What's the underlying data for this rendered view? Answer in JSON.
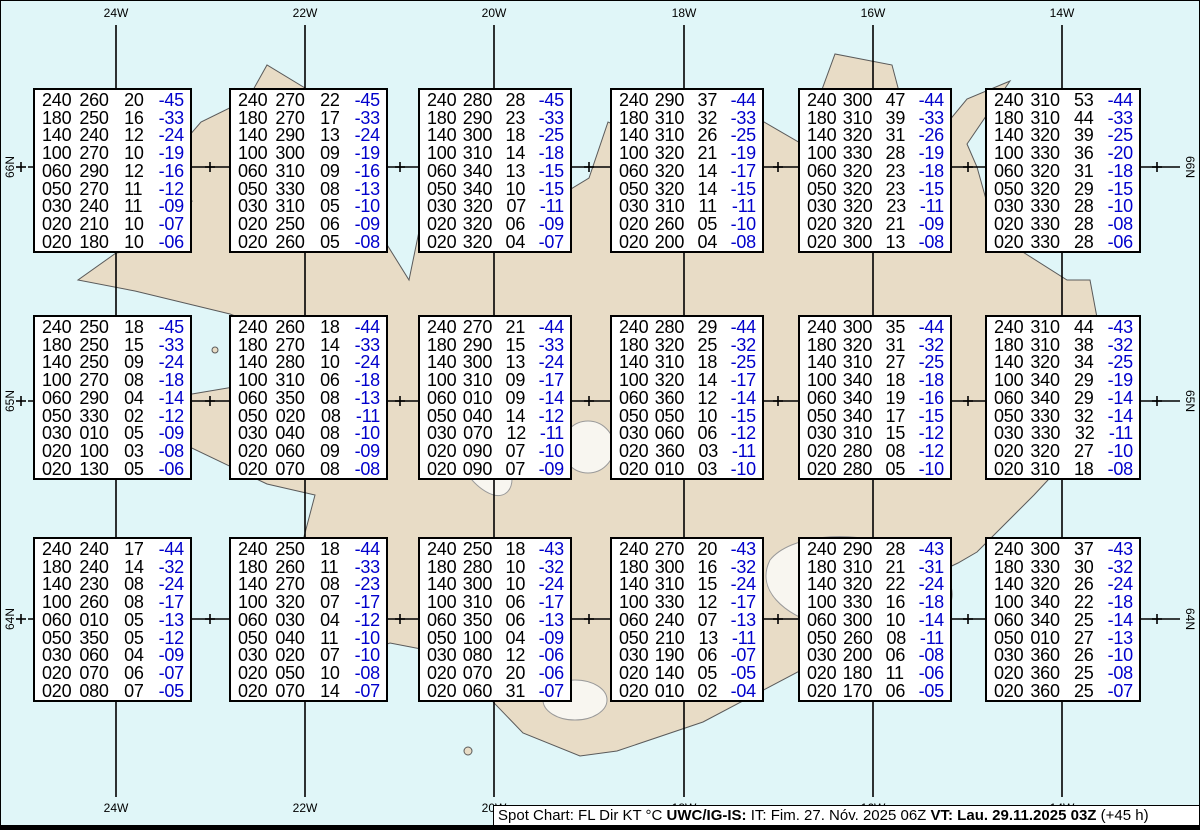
{
  "map": {
    "region": "Iceland",
    "colors": {
      "water": "#E0F6F8",
      "land": "#E8DCC6",
      "coast": "#5A5A5A",
      "glacier_outline": "#999999",
      "graticule": "#000000",
      "box_background": "#FFFFFF",
      "value_black": "#000000",
      "temp_blue": "#0000CC"
    },
    "meridians": [
      {
        "label": "24W",
        "x": 116
      },
      {
        "label": "22W",
        "x": 305
      },
      {
        "label": "20W",
        "x": 494
      },
      {
        "label": "18W",
        "x": 684
      },
      {
        "label": "16W",
        "x": 873
      },
      {
        "label": "14W",
        "x": 1062
      }
    ],
    "parallels": [
      {
        "label": "66N",
        "y": 167
      },
      {
        "label": "65N",
        "y": 401
      },
      {
        "label": "64N",
        "y": 619
      }
    ],
    "half_meridian_ticks_x": [
      21,
      210,
      400,
      589,
      778,
      968,
      1157
    ]
  },
  "layout": {
    "box_cols_x": [
      33,
      229,
      418,
      610,
      798,
      985
    ],
    "box_rows_y": [
      88,
      315,
      537
    ],
    "box_w": [
      159,
      159,
      154,
      154,
      154,
      156
    ],
    "box_h": 165
  },
  "column_legend": [
    "FL",
    "Dir",
    "KT",
    "°C"
  ],
  "boxes": [
    {
      "rows": [
        [
          "240",
          "260",
          "20",
          "-45"
        ],
        [
          "180",
          "250",
          "16",
          "-33"
        ],
        [
          "140",
          "240",
          "12",
          "-24"
        ],
        [
          "100",
          "270",
          "10",
          "-19"
        ],
        [
          "060",
          "290",
          "12",
          "-16"
        ],
        [
          "050",
          "270",
          "11",
          "-12"
        ],
        [
          "030",
          "240",
          "11",
          "-09"
        ],
        [
          "020",
          "210",
          "10",
          "-07"
        ],
        [
          "020",
          "180",
          "10",
          "-06"
        ]
      ]
    },
    {
      "rows": [
        [
          "240",
          "270",
          "22",
          "-45"
        ],
        [
          "180",
          "270",
          "17",
          "-33"
        ],
        [
          "140",
          "290",
          "13",
          "-24"
        ],
        [
          "100",
          "300",
          "09",
          "-19"
        ],
        [
          "060",
          "310",
          "09",
          "-16"
        ],
        [
          "050",
          "330",
          "08",
          "-13"
        ],
        [
          "030",
          "310",
          "05",
          "-10"
        ],
        [
          "020",
          "250",
          "06",
          "-09"
        ],
        [
          "020",
          "260",
          "05",
          "-08"
        ]
      ]
    },
    {
      "rows": [
        [
          "240",
          "280",
          "28",
          "-45"
        ],
        [
          "180",
          "290",
          "23",
          "-33"
        ],
        [
          "140",
          "300",
          "18",
          "-25"
        ],
        [
          "100",
          "310",
          "14",
          "-18"
        ],
        [
          "060",
          "340",
          "13",
          "-15"
        ],
        [
          "050",
          "340",
          "10",
          "-15"
        ],
        [
          "030",
          "320",
          "07",
          "-11"
        ],
        [
          "020",
          "320",
          "06",
          "-09"
        ],
        [
          "020",
          "320",
          "04",
          "-07"
        ]
      ]
    },
    {
      "rows": [
        [
          "240",
          "290",
          "37",
          "-44"
        ],
        [
          "180",
          "310",
          "32",
          "-33"
        ],
        [
          "140",
          "310",
          "26",
          "-25"
        ],
        [
          "100",
          "320",
          "21",
          "-19"
        ],
        [
          "060",
          "320",
          "14",
          "-17"
        ],
        [
          "050",
          "320",
          "14",
          "-15"
        ],
        [
          "030",
          "310",
          "11",
          "-11"
        ],
        [
          "020",
          "260",
          "05",
          "-10"
        ],
        [
          "020",
          "200",
          "04",
          "-08"
        ]
      ]
    },
    {
      "rows": [
        [
          "240",
          "300",
          "47",
          "-44"
        ],
        [
          "180",
          "310",
          "39",
          "-33"
        ],
        [
          "140",
          "320",
          "31",
          "-26"
        ],
        [
          "100",
          "330",
          "28",
          "-19"
        ],
        [
          "060",
          "320",
          "23",
          "-18"
        ],
        [
          "050",
          "320",
          "23",
          "-15"
        ],
        [
          "030",
          "320",
          "23",
          "-11"
        ],
        [
          "020",
          "320",
          "21",
          "-09"
        ],
        [
          "020",
          "300",
          "13",
          "-08"
        ]
      ]
    },
    {
      "rows": [
        [
          "240",
          "310",
          "53",
          "-44"
        ],
        [
          "180",
          "310",
          "44",
          "-33"
        ],
        [
          "140",
          "320",
          "39",
          "-25"
        ],
        [
          "100",
          "330",
          "36",
          "-20"
        ],
        [
          "060",
          "320",
          "31",
          "-18"
        ],
        [
          "050",
          "320",
          "29",
          "-15"
        ],
        [
          "030",
          "330",
          "28",
          "-10"
        ],
        [
          "020",
          "330",
          "28",
          "-08"
        ],
        [
          "020",
          "330",
          "28",
          "-06"
        ]
      ]
    },
    {
      "rows": [
        [
          "240",
          "250",
          "18",
          "-45"
        ],
        [
          "180",
          "250",
          "15",
          "-33"
        ],
        [
          "140",
          "250",
          "09",
          "-24"
        ],
        [
          "100",
          "270",
          "08",
          "-18"
        ],
        [
          "060",
          "290",
          "04",
          "-14"
        ],
        [
          "050",
          "330",
          "02",
          "-12"
        ],
        [
          "030",
          "010",
          "05",
          "-09"
        ],
        [
          "020",
          "100",
          "03",
          "-08"
        ],
        [
          "020",
          "130",
          "05",
          "-06"
        ]
      ]
    },
    {
      "rows": [
        [
          "240",
          "260",
          "18",
          "-44"
        ],
        [
          "180",
          "270",
          "14",
          "-33"
        ],
        [
          "140",
          "280",
          "10",
          "-24"
        ],
        [
          "100",
          "310",
          "06",
          "-18"
        ],
        [
          "060",
          "350",
          "08",
          "-13"
        ],
        [
          "050",
          "020",
          "08",
          "-11"
        ],
        [
          "030",
          "040",
          "08",
          "-10"
        ],
        [
          "020",
          "060",
          "09",
          "-09"
        ],
        [
          "020",
          "070",
          "08",
          "-08"
        ]
      ]
    },
    {
      "rows": [
        [
          "240",
          "270",
          "21",
          "-44"
        ],
        [
          "180",
          "290",
          "15",
          "-33"
        ],
        [
          "140",
          "300",
          "13",
          "-24"
        ],
        [
          "100",
          "310",
          "09",
          "-17"
        ],
        [
          "060",
          "010",
          "09",
          "-14"
        ],
        [
          "050",
          "040",
          "14",
          "-12"
        ],
        [
          "030",
          "070",
          "12",
          "-11"
        ],
        [
          "020",
          "090",
          "07",
          "-10"
        ],
        [
          "020",
          "090",
          "07",
          "-09"
        ]
      ]
    },
    {
      "rows": [
        [
          "240",
          "280",
          "29",
          "-44"
        ],
        [
          "180",
          "320",
          "25",
          "-32"
        ],
        [
          "140",
          "310",
          "18",
          "-25"
        ],
        [
          "100",
          "320",
          "14",
          "-17"
        ],
        [
          "060",
          "360",
          "12",
          "-14"
        ],
        [
          "050",
          "050",
          "10",
          "-15"
        ],
        [
          "030",
          "060",
          "06",
          "-12"
        ],
        [
          "020",
          "360",
          "03",
          "-11"
        ],
        [
          "020",
          "010",
          "03",
          "-10"
        ]
      ]
    },
    {
      "rows": [
        [
          "240",
          "300",
          "35",
          "-44"
        ],
        [
          "180",
          "320",
          "31",
          "-32"
        ],
        [
          "140",
          "310",
          "27",
          "-25"
        ],
        [
          "100",
          "340",
          "18",
          "-18"
        ],
        [
          "060",
          "340",
          "19",
          "-16"
        ],
        [
          "050",
          "340",
          "17",
          "-15"
        ],
        [
          "030",
          "310",
          "15",
          "-12"
        ],
        [
          "020",
          "280",
          "08",
          "-12"
        ],
        [
          "020",
          "280",
          "05",
          "-10"
        ]
      ]
    },
    {
      "rows": [
        [
          "240",
          "310",
          "44",
          "-43"
        ],
        [
          "180",
          "310",
          "38",
          "-32"
        ],
        [
          "140",
          "320",
          "34",
          "-25"
        ],
        [
          "100",
          "340",
          "29",
          "-19"
        ],
        [
          "060",
          "340",
          "29",
          "-14"
        ],
        [
          "050",
          "330",
          "32",
          "-14"
        ],
        [
          "030",
          "330",
          "32",
          "-11"
        ],
        [
          "020",
          "320",
          "27",
          "-10"
        ],
        [
          "020",
          "310",
          "18",
          "-08"
        ]
      ]
    },
    {
      "rows": [
        [
          "240",
          "240",
          "17",
          "-44"
        ],
        [
          "180",
          "240",
          "14",
          "-32"
        ],
        [
          "140",
          "230",
          "08",
          "-24"
        ],
        [
          "100",
          "260",
          "08",
          "-17"
        ],
        [
          "060",
          "010",
          "05",
          "-13"
        ],
        [
          "050",
          "350",
          "05",
          "-12"
        ],
        [
          "030",
          "060",
          "04",
          "-09"
        ],
        [
          "020",
          "070",
          "06",
          "-07"
        ],
        [
          "020",
          "080",
          "07",
          "-05"
        ]
      ]
    },
    {
      "rows": [
        [
          "240",
          "250",
          "18",
          "-44"
        ],
        [
          "180",
          "260",
          "11",
          "-33"
        ],
        [
          "140",
          "270",
          "08",
          "-23"
        ],
        [
          "100",
          "320",
          "07",
          "-17"
        ],
        [
          "060",
          "030",
          "04",
          "-12"
        ],
        [
          "050",
          "040",
          "11",
          "-10"
        ],
        [
          "030",
          "020",
          "07",
          "-10"
        ],
        [
          "020",
          "050",
          "10",
          "-08"
        ],
        [
          "020",
          "070",
          "14",
          "-07"
        ]
      ]
    },
    {
      "rows": [
        [
          "240",
          "250",
          "18",
          "-43"
        ],
        [
          "180",
          "280",
          "10",
          "-32"
        ],
        [
          "140",
          "300",
          "10",
          "-24"
        ],
        [
          "100",
          "310",
          "06",
          "-17"
        ],
        [
          "060",
          "350",
          "06",
          "-13"
        ],
        [
          "050",
          "100",
          "04",
          "-09"
        ],
        [
          "030",
          "080",
          "12",
          "-06"
        ],
        [
          "020",
          "070",
          "20",
          "-06"
        ],
        [
          "020",
          "060",
          "31",
          "-07"
        ]
      ]
    },
    {
      "rows": [
        [
          "240",
          "270",
          "20",
          "-43"
        ],
        [
          "180",
          "300",
          "16",
          "-32"
        ],
        [
          "140",
          "310",
          "15",
          "-24"
        ],
        [
          "100",
          "330",
          "12",
          "-17"
        ],
        [
          "060",
          "240",
          "07",
          "-13"
        ],
        [
          "050",
          "210",
          "13",
          "-11"
        ],
        [
          "030",
          "190",
          "06",
          "-07"
        ],
        [
          "020",
          "140",
          "05",
          "-05"
        ],
        [
          "020",
          "010",
          "02",
          "-04"
        ]
      ]
    },
    {
      "rows": [
        [
          "240",
          "290",
          "28",
          "-43"
        ],
        [
          "180",
          "310",
          "21",
          "-31"
        ],
        [
          "140",
          "320",
          "22",
          "-24"
        ],
        [
          "100",
          "330",
          "16",
          "-18"
        ],
        [
          "060",
          "300",
          "10",
          "-14"
        ],
        [
          "050",
          "260",
          "08",
          "-11"
        ],
        [
          "030",
          "200",
          "06",
          "-08"
        ],
        [
          "020",
          "180",
          "11",
          "-06"
        ],
        [
          "020",
          "170",
          "06",
          "-05"
        ]
      ]
    },
    {
      "rows": [
        [
          "240",
          "300",
          "37",
          "-43"
        ],
        [
          "180",
          "330",
          "30",
          "-32"
        ],
        [
          "140",
          "320",
          "26",
          "-24"
        ],
        [
          "100",
          "340",
          "22",
          "-18"
        ],
        [
          "060",
          "340",
          "25",
          "-14"
        ],
        [
          "050",
          "010",
          "27",
          "-13"
        ],
        [
          "030",
          "360",
          "26",
          "-10"
        ],
        [
          "020",
          "360",
          "25",
          "-08"
        ],
        [
          "020",
          "360",
          "25",
          "-07"
        ]
      ]
    }
  ],
  "footer": {
    "segments": [
      {
        "text": "Spot Chart: FL Dir KT °C ",
        "bold": false
      },
      {
        "text": "UWC/IG-IS:",
        "bold": true
      },
      {
        "text": " IT: Fim. 27. Nóv. 2025 06Z ",
        "bold": false
      },
      {
        "text": "VT: Lau. 29.11.2025 03Z",
        "bold": true
      },
      {
        "text": " (+45 h)",
        "bold": false
      }
    ]
  }
}
